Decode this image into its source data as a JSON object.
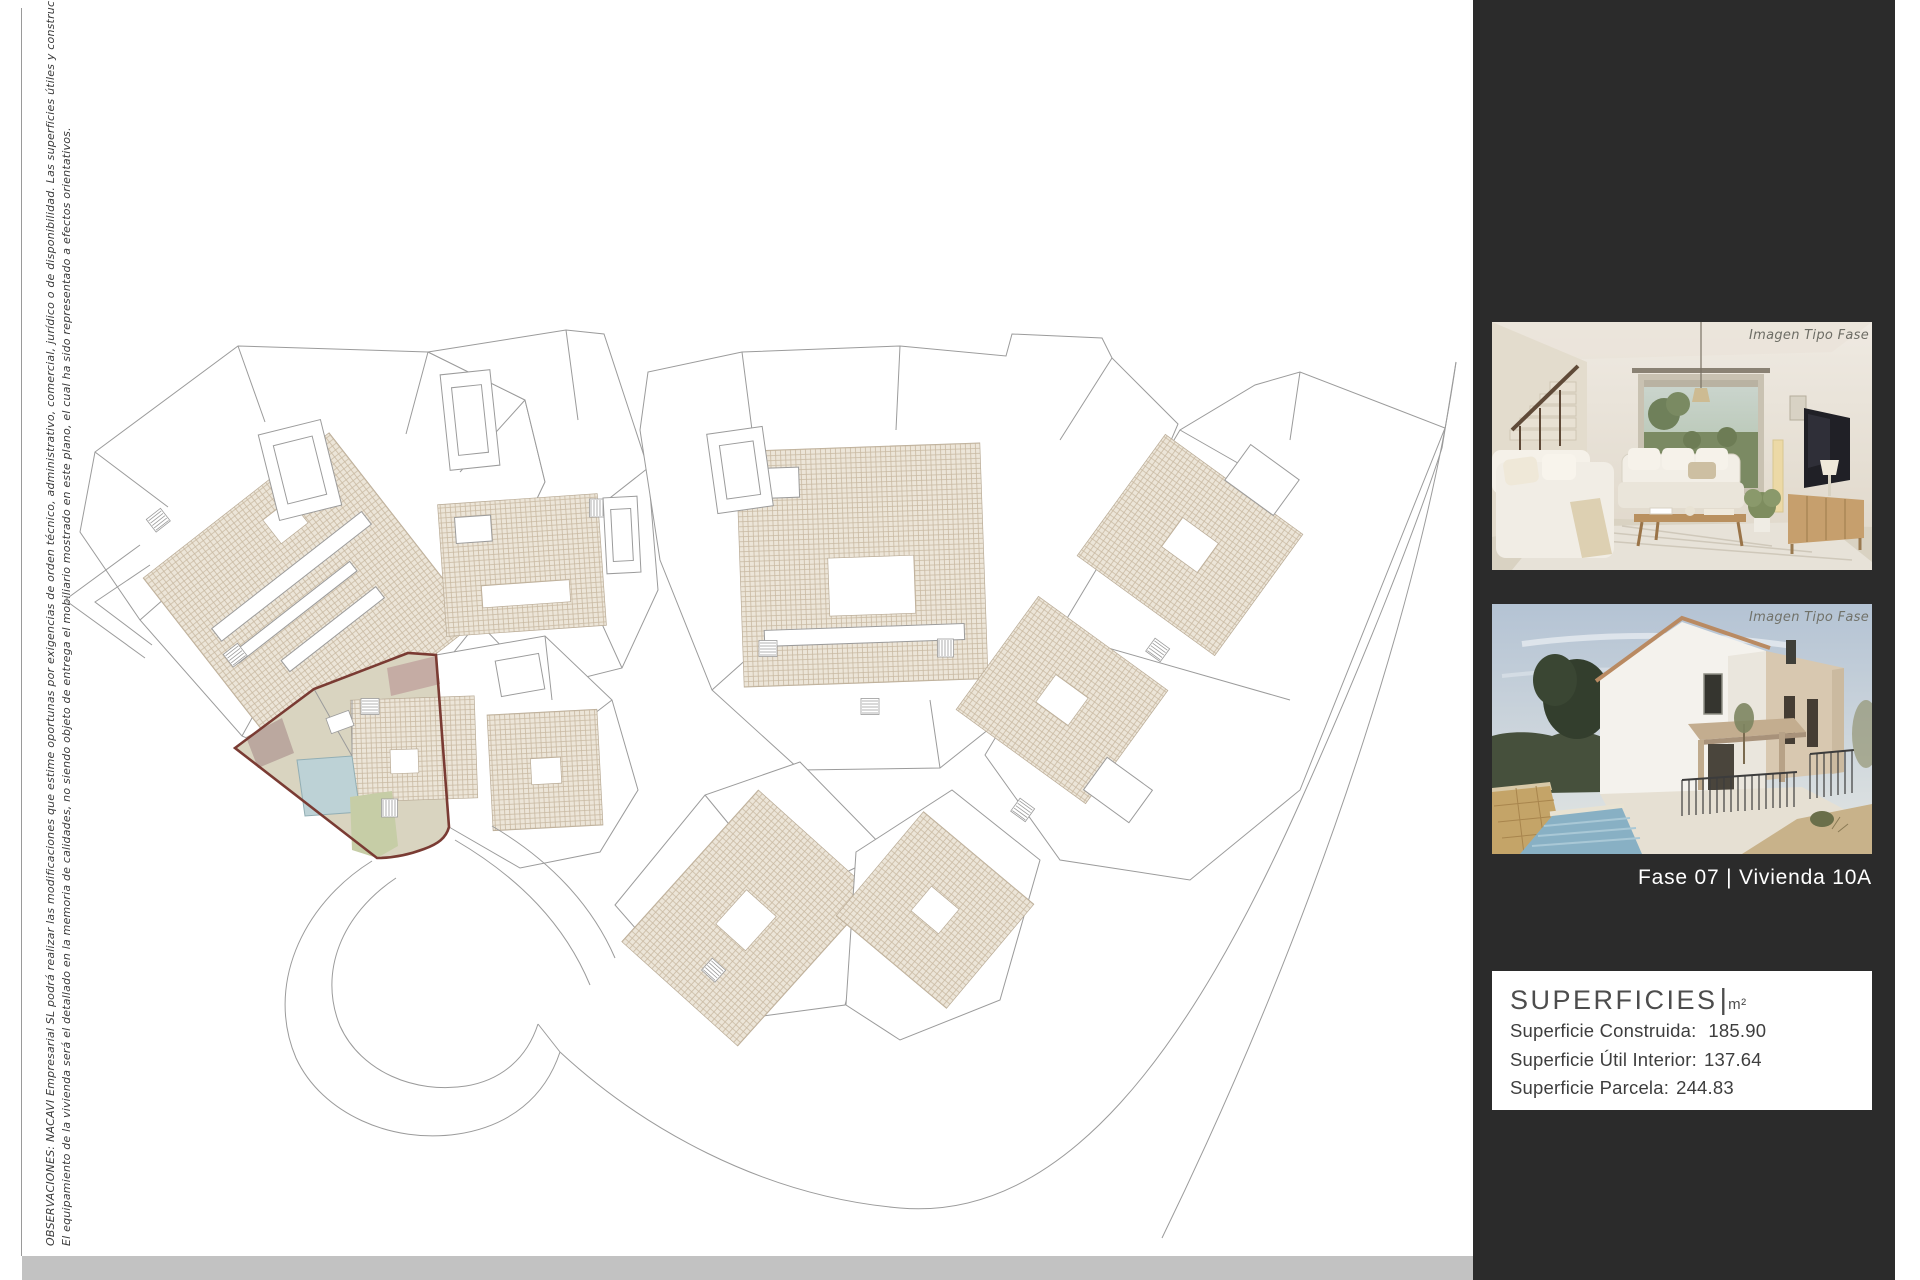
{
  "disclaimer": {
    "line1": "OBSERVACIONES: NACAVI Empresarial SL podrá realizar las modificaciones que estime oportunas por exigencias de orden técnico, administrativo, comercial, jurídico o de disponibilidad. Las superficies útiles y constructivas son aproximadas.",
    "line2": "El equipamiento de la vivienda será el detallado en la memoria de calidades, no siendo objeto de entrega el mobiliario mostrado en este plano, el cual ha sido representado a efectos orientativos."
  },
  "site_plan": {
    "highlighted_unit": "Vivienda 10A",
    "colors": {
      "highlight_border": "#7a3b33",
      "highlight_fill": "#d9d4c0",
      "pool": "#bdd2d6",
      "garden": "#c6cda6",
      "terrace": "#c3aaa2",
      "roof_hatch": "#c9b9a2",
      "line": "#9b9b9b"
    }
  },
  "panel": {
    "background": "#2b2b2b",
    "images": [
      {
        "caption": "Imagen Tipo Fase"
      },
      {
        "caption": "Imagen Tipo Fase"
      }
    ],
    "phase_label": "Fase 07 |  Vivienda 10A",
    "superficies": {
      "title": "SUPERFICIES",
      "separator": "|",
      "unit": "m²",
      "rows": [
        {
          "label": "Superficie Construida:",
          "value": "185.90"
        },
        {
          "label": "Superficie Útil Interior:",
          "value": "137.64"
        },
        {
          "label": "Superficie Parcela:",
          "value": "244.83"
        }
      ]
    }
  }
}
